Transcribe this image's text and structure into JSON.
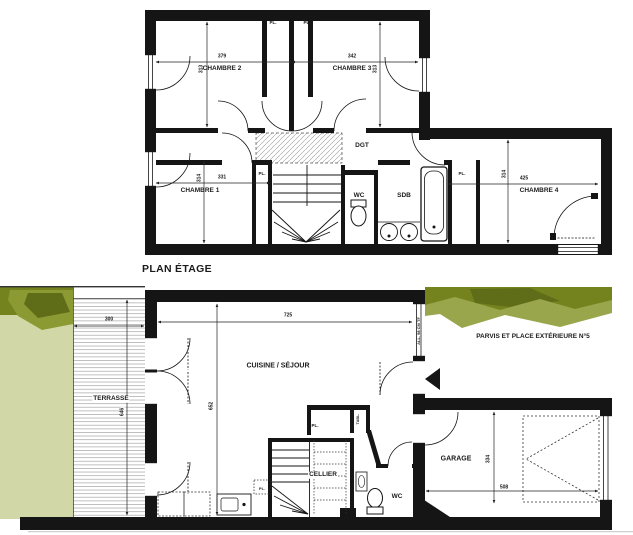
{
  "colors": {
    "wall": "#151515",
    "lawn": "#d2d7a8",
    "hedge_dark": "#75831f",
    "hedge_mid": "#9aa64c",
    "hedge_deep": "#5f6d18",
    "deck_line": "#b9b9b9"
  },
  "upper": {
    "title": "PLAN ÉTAGE",
    "rooms": {
      "chambre1": {
        "name": "CHAMBRE 1",
        "width": "331",
        "height": "314"
      },
      "chambre2": {
        "name": "CHAMBRE 2",
        "width": "379",
        "height": "313"
      },
      "chambre3": {
        "name": "CHAMBRE 3",
        "width": "342",
        "height": "313"
      },
      "chambre4": {
        "name": "CHAMBRE 4",
        "width": "425",
        "height": "314"
      },
      "dgt": {
        "name": "DGT"
      },
      "wc": {
        "name": "WC"
      },
      "sdb": {
        "name": "SDB"
      }
    }
  },
  "ground": {
    "rooms": {
      "terrasse": {
        "name": "TERRASSE",
        "width": "300",
        "height": "646"
      },
      "cuisine": {
        "name": "CUISINE / SÉJOUR",
        "width": "725",
        "height": "652"
      },
      "cellier": {
        "name": "CELLIER"
      },
      "wc": {
        "name": "WC"
      },
      "garage": {
        "name": "GARAGE",
        "width": "508",
        "height": "334"
      },
      "parvis": {
        "name": "PARVIS ET PLACE EXTÉRIEURE N°5"
      }
    },
    "window_note": "ALL. 98 CM TF",
    "tabl_label": "TABL."
  },
  "shared": {
    "closet_label": "PL."
  }
}
